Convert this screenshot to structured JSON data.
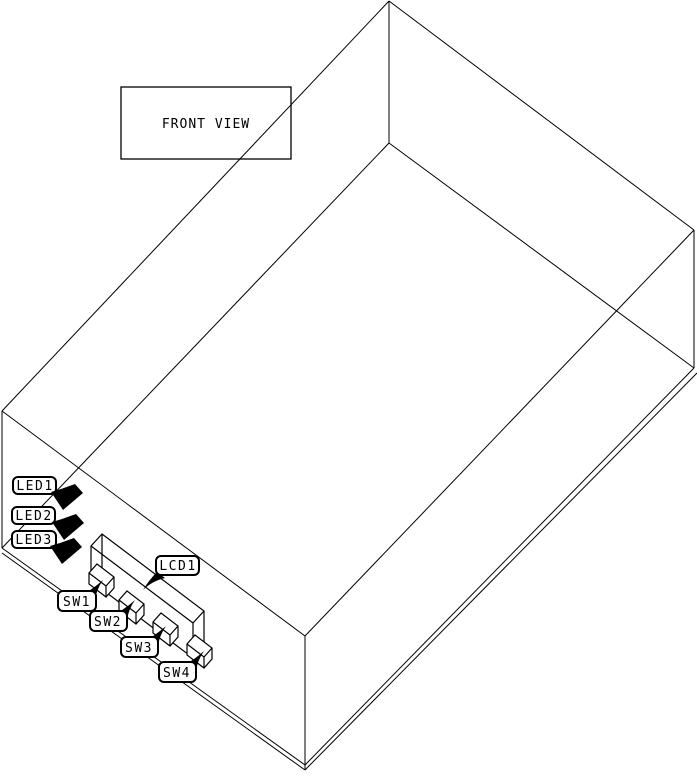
{
  "view_label": {
    "text": "FRONT VIEW"
  },
  "callouts": [
    {
      "id": "LED1",
      "text": "LED1",
      "component": "led-indicator"
    },
    {
      "id": "LED2",
      "text": "LED2",
      "component": "led-indicator"
    },
    {
      "id": "LED3",
      "text": "LED3",
      "component": "led-indicator"
    },
    {
      "id": "LCD1",
      "text": "LCD1",
      "component": "lcd-display"
    },
    {
      "id": "SW1",
      "text": "SW1",
      "component": "push-switch"
    },
    {
      "id": "SW2",
      "text": "SW2",
      "component": "push-switch"
    },
    {
      "id": "SW3",
      "text": "SW3",
      "component": "push-switch"
    },
    {
      "id": "SW4",
      "text": "SW4",
      "component": "push-switch"
    }
  ],
  "colors": {
    "line": "#000000",
    "background": "#ffffff",
    "label_fill": "#ffffff",
    "component_fill": "#000000"
  }
}
